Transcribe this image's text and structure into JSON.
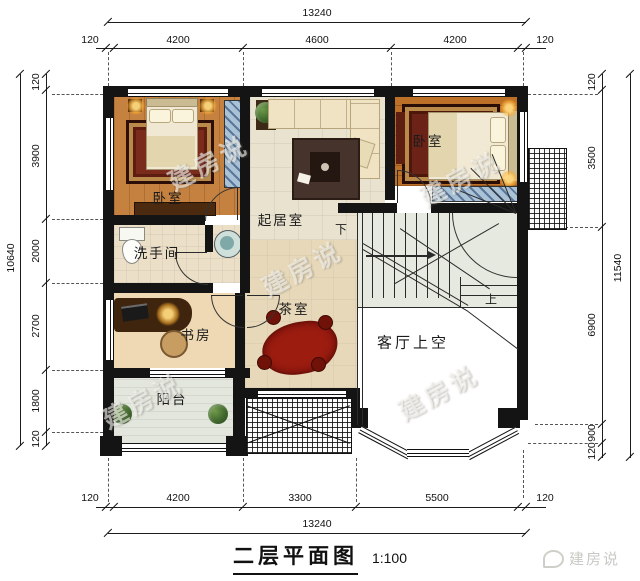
{
  "title": {
    "name": "二层平面图",
    "scale": "1:100"
  },
  "brand": {
    "name": "建房说"
  },
  "watermark": "建房说",
  "dims": {
    "top": {
      "total": "13240",
      "s": [
        "120",
        "4200",
        "4600",
        "4200",
        "120"
      ]
    },
    "bottom": {
      "total": "13240",
      "s": [
        "120",
        "4200",
        "3300",
        "5500",
        "120"
      ]
    },
    "left": {
      "total": "10640",
      "s": [
        "120",
        "3900",
        "2000",
        "2700",
        "1800",
        "120"
      ]
    },
    "right": {
      "total": "11540",
      "s": [
        "120",
        "3500",
        "6900",
        "900",
        "120"
      ]
    }
  },
  "rooms": {
    "bedroom_left": "卧室",
    "bedroom_right": "卧室",
    "living": "起居室",
    "bath": "洗手间",
    "study": "书房",
    "tea": "茶室",
    "void": "客厅上空",
    "balcony": "阳台"
  },
  "stairs": {
    "down": "下",
    "up": "上"
  },
  "colors": {
    "wall": "#141414",
    "bedroom_floor": "#c5813f",
    "plank_floor": "#bd7128",
    "living_floor": "#e9e2cf",
    "rug_red": "#7b2b1b",
    "tea_rug_red": "#9c1c10",
    "hatch_blue": "#a9c2d6"
  }
}
